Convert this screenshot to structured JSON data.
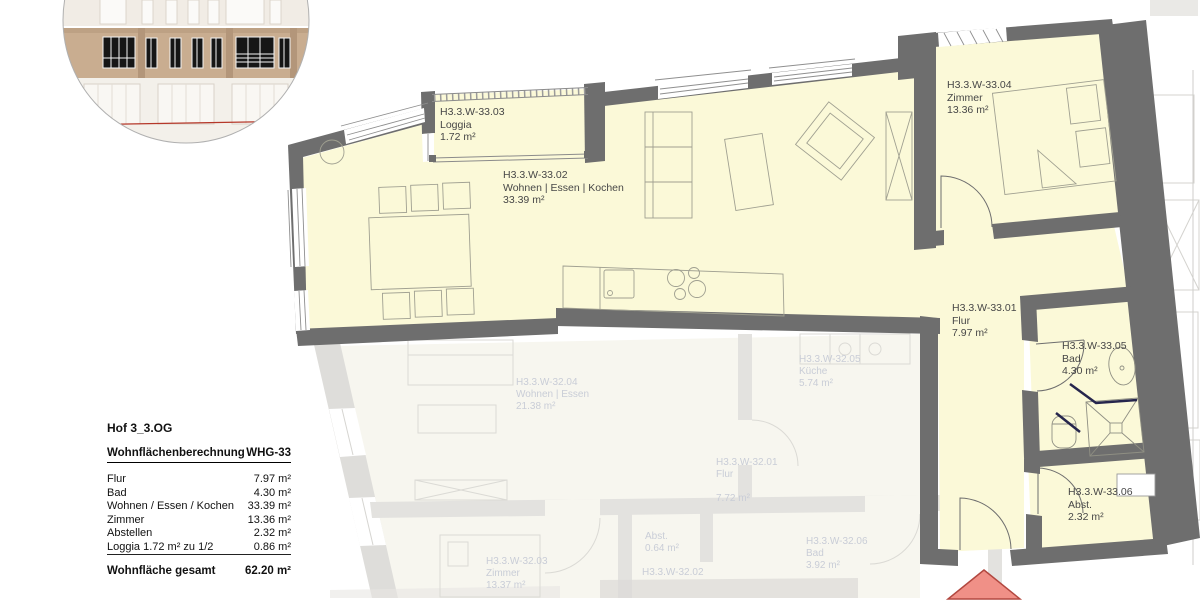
{
  "colors": {
    "floor_active": "#fbf9d8",
    "wall": "#6e6e6e",
    "faded_wall": "#e3e2df",
    "faded_text": "#c9cdd7",
    "label_text": "#474747",
    "entrance_arrow_fill": "#f09087",
    "entrance_arrow_stroke": "#b24840",
    "facade_band": "#c9ad90",
    "facade_red_line": "#b5382a"
  },
  "plan": {
    "rooms": [
      {
        "id": "H3.3.W-33.03",
        "name": "Loggia",
        "area": "1.72 m²"
      },
      {
        "id": "H3.3.W-33.02",
        "name": "Wohnen | Essen | Kochen",
        "area": "33.39 m²"
      },
      {
        "id": "H3.3.W-33.04",
        "name": "Zimmer",
        "area": "13.36 m²"
      },
      {
        "id": "H3.3.W-33.01",
        "name": "Flur",
        "area": "7.97 m²"
      },
      {
        "id": "H3.3.W-33.05",
        "name": "Bad",
        "area": "4.30 m²"
      },
      {
        "id": "H3.3.W-33.06",
        "name": "Abst.",
        "area": "2.32 m²"
      }
    ],
    "faded_rooms": [
      {
        "id": "H3.3.W-32.04",
        "name": "Wohnen | Essen",
        "area": "21.38 m²"
      },
      {
        "id": "H3.3.W-32.05",
        "name": "Küche",
        "area": "5.74 m²"
      },
      {
        "id": "H3.3.W-32.01",
        "name": "Flur",
        "area": "7.72 m²"
      },
      {
        "id": "",
        "name": "Abst.",
        "area": "0.64 m²"
      },
      {
        "id": "H3.3.W-32.06",
        "name": "Bad",
        "area": "3.92 m²"
      },
      {
        "id": "H3.3.W-32.03",
        "name": "Zimmer",
        "area": "13.37 m²"
      },
      {
        "id": "H3.3.W-32.02",
        "name": "",
        "area": ""
      }
    ]
  },
  "summary": {
    "project": "Hof 3_3.OG",
    "heading": "Wohnflächenberechnung",
    "unit": "WHG-33",
    "rows": [
      {
        "label": "Flur",
        "value": "7.97 m²"
      },
      {
        "label": "Bad",
        "value": "4.30 m²"
      },
      {
        "label": "Wohnen / Essen / Kochen",
        "value": "33.39 m²"
      },
      {
        "label": "Zimmer",
        "value": "13.36 m²"
      },
      {
        "label": "Abstellen",
        "value": "2.32 m²"
      },
      {
        "label": "Loggia 1.72 m² zu 1/2",
        "value": "0.86 m²"
      }
    ],
    "total_label": "Wohnfläche gesamt",
    "total_value": "62.20 m²"
  }
}
